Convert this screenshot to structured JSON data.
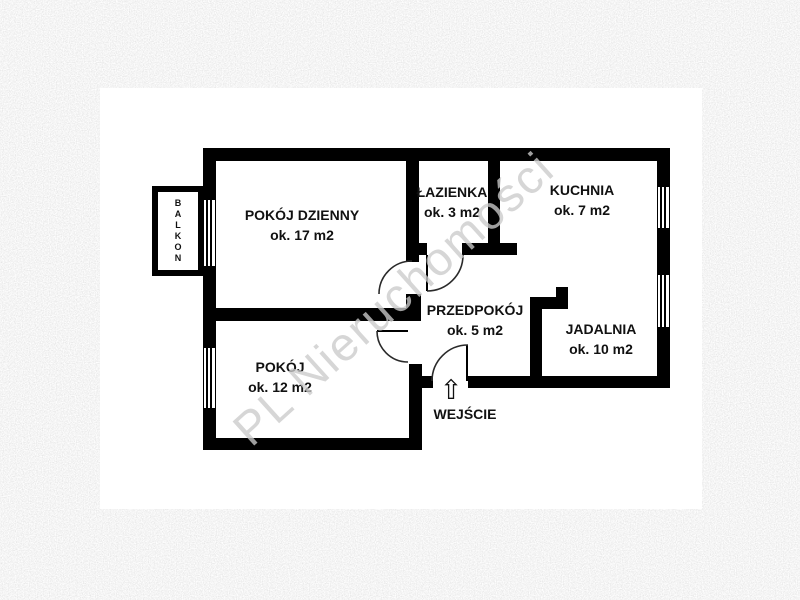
{
  "floorplan": {
    "watermark_text": "PL Nieruchomości",
    "balcony": {
      "label": "BALKON"
    },
    "entrance": {
      "label": "WEJŚCIE"
    },
    "rooms": [
      {
        "name": "POKÓJ DZIENNY",
        "area": "ok. 17 m2"
      },
      {
        "name": "ŁAZIENKA",
        "area": "ok. 3 m2"
      },
      {
        "name": "KUCHNIA",
        "area": "ok. 7 m2"
      },
      {
        "name": "PRZEDPOKÓJ",
        "area": "ok. 5 m2"
      },
      {
        "name": "JADALNIA",
        "area": "ok. 10 m2"
      },
      {
        "name": "POKÓJ",
        "area": "ok. 12 m2"
      }
    ],
    "colors": {
      "wall": "#000000",
      "floor": "#ffffff",
      "watermark": "#c8c8c8",
      "background_noise": "#d6d6d6"
    }
  }
}
